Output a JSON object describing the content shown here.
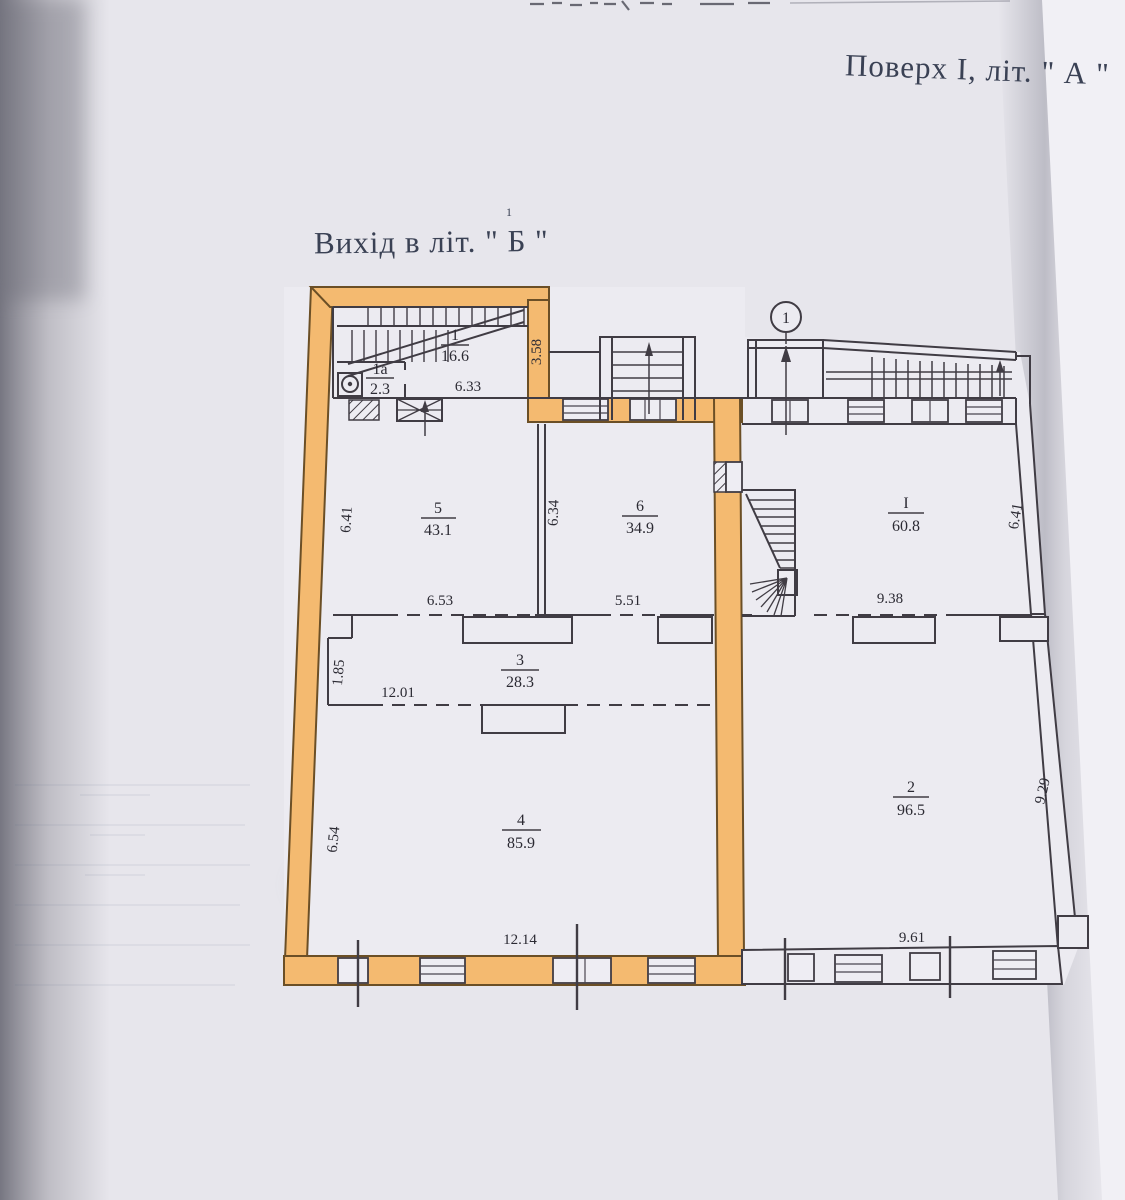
{
  "page": {
    "title": "Поверх І, літ. \" А \"",
    "exit_label": "Вихід в літ. \" Б \"",
    "exit_sup": "1"
  },
  "plan": {
    "entrance_marker": "1",
    "rooms": {
      "r1": {
        "number": "1",
        "area": "16.6"
      },
      "r1a": {
        "number": "1а",
        "area": "2.3"
      },
      "r5": {
        "number": "5",
        "area": "43.1"
      },
      "r6": {
        "number": "6",
        "area": "34.9"
      },
      "r3": {
        "number": "3",
        "area": "28.3"
      },
      "r4": {
        "number": "4",
        "area": "85.9"
      },
      "rI": {
        "number": "І",
        "area": "60.8"
      },
      "r2": {
        "number": "2",
        "area": "96.5"
      }
    },
    "dimensions": {
      "room1_width": "6.33",
      "room1_depth": "3.58",
      "room5_height": "6.41",
      "room6_height": "6.34",
      "room5_width": "6.53",
      "room6_width": "5.51",
      "corridor_niche": "1.85",
      "corridor_width": "12.01",
      "room4_height": "6.54",
      "room4_width": "12.14",
      "roomI_width": "9.38",
      "roomI_height": "6.41",
      "room2_width": "9.61",
      "room2_height": "9.29"
    }
  },
  "colors": {
    "highlight_orange": "#f4ba70",
    "ink": "#403c44",
    "paper": "#e7e6ec",
    "title_ink": "#3a4154"
  }
}
